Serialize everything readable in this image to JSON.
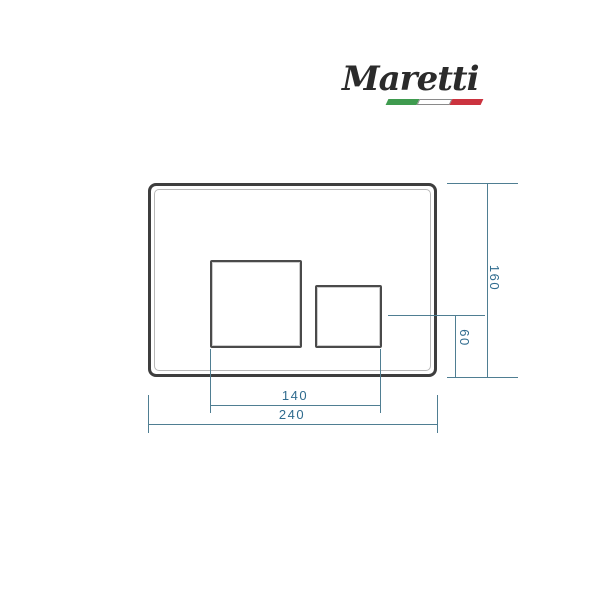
{
  "brand": {
    "name": "Maretti"
  },
  "drawing": {
    "dim_plate_height": "160",
    "dim_small_button_to_bottom": "60",
    "dim_buttons_span": "140",
    "dim_plate_width": "240"
  },
  "colors": {
    "accent": "#4f7e92",
    "dim_text": "#2f6b8e",
    "plate_border": "#3e3e3e",
    "logo_text": "#2b2b2b",
    "flag_green": "#3f9b4f",
    "flag_white": "#ffffff",
    "flag_red": "#cb333f"
  }
}
